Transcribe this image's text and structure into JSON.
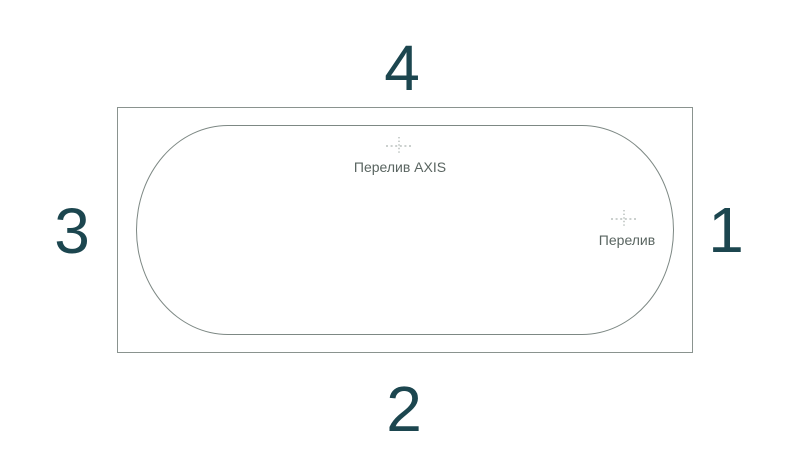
{
  "scheme": {
    "side_numbers": {
      "top": "4",
      "bottom": "2",
      "left": "3",
      "right": "1"
    },
    "markers": {
      "axis_overflow": {
        "label": "Перелив AXIS"
      },
      "overflow": {
        "label": "Перелив"
      }
    },
    "colors": {
      "side_number": "#1c464f",
      "marker_label": "#5a6561",
      "outer_outline": "#8a938f",
      "inner_outline": "#7d8884",
      "crosshair": "#97a19d",
      "background": "#ffffff"
    }
  }
}
